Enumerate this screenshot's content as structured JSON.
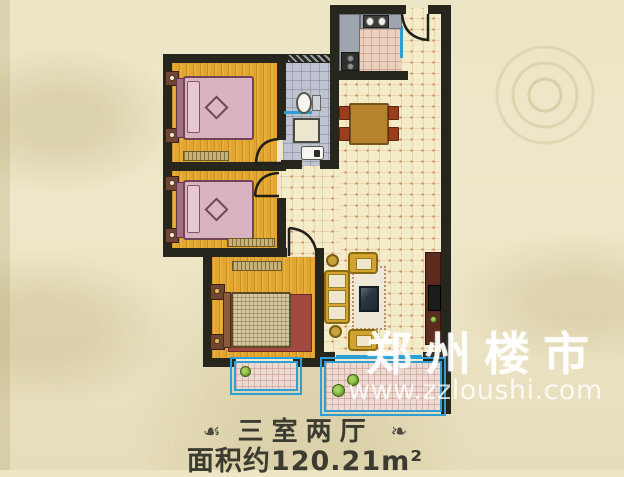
{
  "type": "real-estate-floor-plan",
  "caption": {
    "ornament_left": "☙",
    "title": "三室两厅",
    "ornament_right": "❧",
    "area": "面积约120.21m²"
  },
  "watermark": {
    "brand": "郑州楼市",
    "url": "www.zzloushi.com"
  },
  "plan": {
    "layout": "3 bedrooms, 2 halls",
    "area_value": "120.21",
    "area_unit": "m²",
    "rooms": [
      {
        "name": "bedroom-1"
      },
      {
        "name": "bedroom-2"
      },
      {
        "name": "master-bedroom"
      },
      {
        "name": "bathroom"
      },
      {
        "name": "kitchen"
      },
      {
        "name": "dining-area"
      },
      {
        "name": "living-room"
      },
      {
        "name": "balcony-small"
      },
      {
        "name": "balcony-large"
      }
    ],
    "colors": {
      "wall": "#26261d",
      "bedroom_floor": "#e2a52f",
      "living_floor": "#f4ebc9",
      "bath_floor": "#bfc3cf",
      "kitchen_floor": "#ead0bf",
      "balcony_floor": "#ecd9d2",
      "window": "#2e9fd4",
      "bed": "#d9b3c0",
      "sofa": "#d2a32e",
      "rug": "#a34840",
      "background": "#ece5c6"
    }
  }
}
